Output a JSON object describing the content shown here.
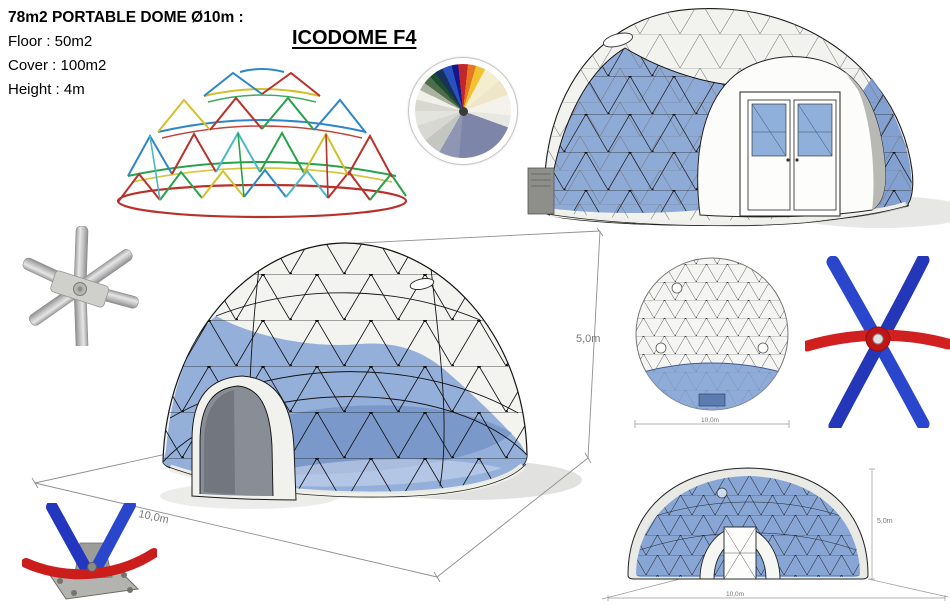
{
  "specs": {
    "title": "78m2 PORTABLE DOME Ø10m :",
    "floor": "Floor : 50m2",
    "cover": "Cover : 100m2",
    "height": "Height : 4m"
  },
  "heading": "ICODOME F4",
  "main_view": {
    "width_label": "10,0m",
    "height_label": "5,0m"
  },
  "top_view": {
    "width_label": "10,0m"
  },
  "front_view": {
    "width_label": "10,0m",
    "height_label": "5,0m"
  },
  "palette": {
    "panel_blue": "#7c9fd4",
    "panel_blue_dark": "#5b7cb0",
    "shell_white": "#f2f2ef",
    "tube_blue": "#2a46cc",
    "tube_red": "#d02020",
    "steel": "#c9c9c9",
    "frame_strut_colors": [
      "#b8312b",
      "#27a24a",
      "#d4c02a",
      "#2e86c8",
      "#49b8c8"
    ]
  }
}
